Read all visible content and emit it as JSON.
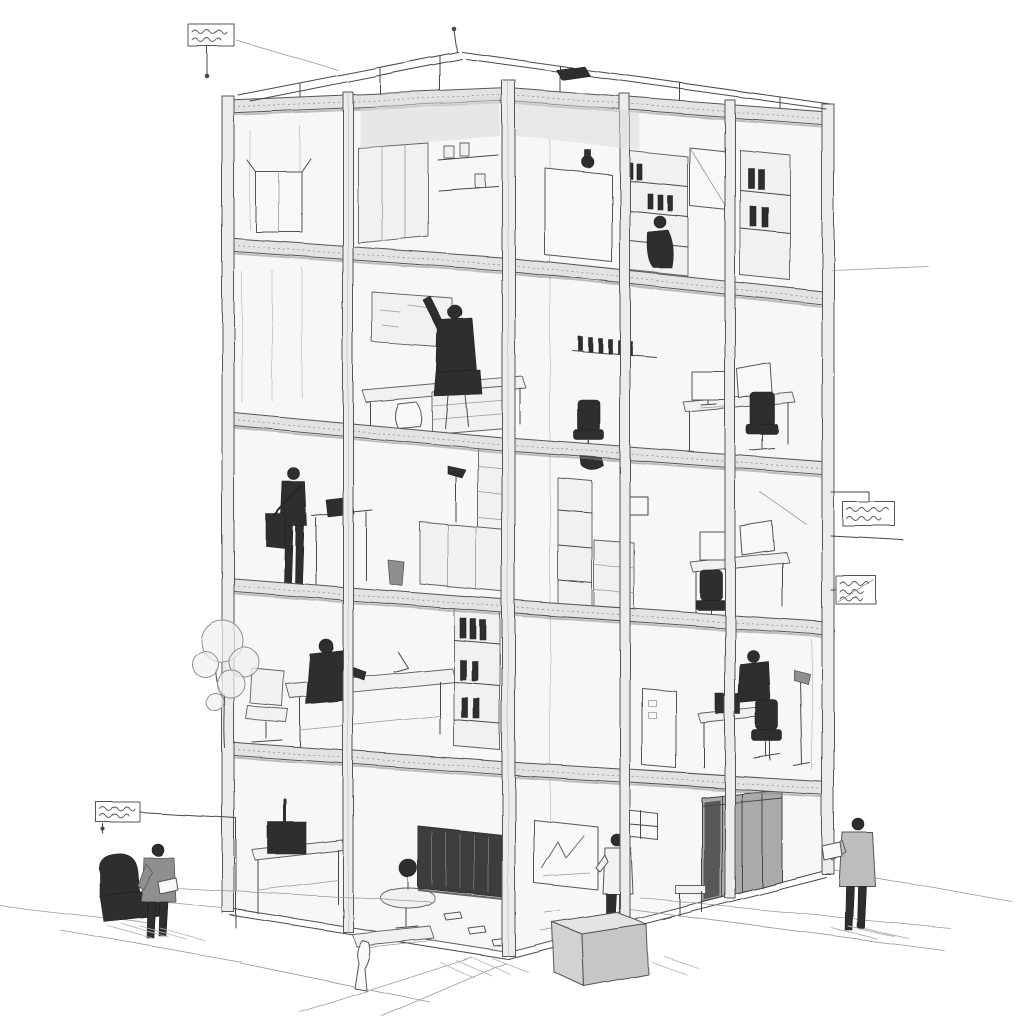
{
  "scene": {
    "kind": "Hand-drawn architectural concept sketch",
    "projection": "two-point perspective dollhouse cutaway",
    "subject": "Five-storey post-and-beam office building cutaway with furnished interiors, rooftop frame, site figures, a young tree and four handwritten callout notes",
    "paper_color": "#ffffff",
    "ink_color": "#474747"
  },
  "building": {
    "storeys_visible": 5,
    "roof": "open beam frame rising to an apex with a small antenna and a dark rooftop unit",
    "frame": "exposed columns and floor slabs; facade removed to reveal rooms on two faces"
  },
  "rooms": [
    {
      "id": "room-5l-storage",
      "level": 5,
      "side": "left",
      "contents": "open carton with lifted flaps, freestanding partition panel, wall shelf with small boxes"
    },
    {
      "id": "room-5r-shelving",
      "level": 5,
      "side": "right",
      "contents": "counter with dark vase, tall open shelving with books, white cabinet, crouching figure, binder shelf"
    },
    {
      "id": "room-4l-workshop",
      "level": 4,
      "side": "left",
      "contents": "back windows, pin-board, workbench with drawer unit, seated worker raising one arm, small white crouching shape"
    },
    {
      "id": "room-4r-office",
      "level": 4,
      "side": "right",
      "contents": "bottle shelf on wall, desk with two monitors and keyboard, two dark task chairs"
    },
    {
      "id": "room-3l-lectern",
      "level": 3,
      "side": "left",
      "contents": "standing worker with shoulder bag at laptop lectern, tall bookcase, service counter, lamp, waste bin"
    },
    {
      "id": "room-3r-workstation",
      "level": 3,
      "side": "right",
      "contents": "small wall picture, pendant lamp, shelf-and-drawer cabinet, desk with two monitors, dark task chair"
    },
    {
      "id": "room-2l-drafting",
      "level": 2,
      "side": "left",
      "contents": "empty task chair, drafting table with lamp, seated draughtsman, binder shelf"
    },
    {
      "id": "room-2r-study",
      "level": 2,
      "side": "right",
      "contents": "tall white cabinet, desk with dark laptop, seated worker, task chair, floor lamp"
    },
    {
      "id": "room-gl-office",
      "level": 1,
      "side": "left",
      "contents": "equipment table with dark machine, round side table with potted plant, loose papers on the floor"
    },
    {
      "id": "corridor-ground",
      "level": 1,
      "side": "center",
      "contents": "dark slatted service corridor opening"
    },
    {
      "id": "room-gr-meeting",
      "level": 1,
      "side": "right",
      "contents": "whiteboard with sketched chart, standing presenter, high window, grey locker bank, low stool, floor clutter"
    }
  ],
  "figures": [
    {
      "id": "figure-worker-raised-arm",
      "where": "level 4 left workshop",
      "pose": "seated at bench, one arm raised"
    },
    {
      "id": "figure-crouching",
      "where": "level 5 right",
      "pose": "crouching beside shelving"
    },
    {
      "id": "figure-standing-bag",
      "where": "level 3 left",
      "pose": "standing at lectern with shoulder bag"
    },
    {
      "id": "figure-draughtsman",
      "where": "level 2 left",
      "pose": "seated at drafting table"
    },
    {
      "id": "figure-seated-study",
      "where": "level 2 right",
      "pose": "seated at desk"
    },
    {
      "id": "figure-presenter",
      "where": "ground floor right",
      "pose": "standing at whiteboard"
    },
    {
      "id": "figure-visitor",
      "where": "site lower left",
      "pose": "standing, reading papers beside a dark armchair"
    },
    {
      "id": "figure-observer",
      "where": "site lower right",
      "pose": "standing at building corner holding a pad"
    },
    {
      "id": "small-white-figure",
      "where": "entry front corner",
      "pose": "small pale figure by the steps"
    }
  ],
  "site": {
    "left": [
      "young sketched tree",
      "dark armchair",
      "hatched shadow"
    ],
    "entry": [
      "front step platform",
      "large three-quarter crate"
    ],
    "ground": "perspective pavement joint lines radiating toward the lower corners"
  },
  "callouts": [
    {
      "id": "callout-top-left",
      "writing": "illegible handwriting, two scribbled lines",
      "leader": "drops vertically to the roof frame"
    },
    {
      "id": "callout-right-upper",
      "writing": "illegible handwriting, two scribbled lines",
      "leader": "steps left to the upper slab edge"
    },
    {
      "id": "callout-right-lower",
      "writing": "illegible handwriting, struck through",
      "leader": "long rule toward the facade at mid-height"
    },
    {
      "id": "callout-bottom-left",
      "writing": "illegible handwriting, two scribbled lines",
      "leader": "runs right then down beside the site figure"
    }
  ],
  "palette": {
    "ink": "#474747",
    "light_wash": "#e3e3e3",
    "mid_wash": "#ababab",
    "dark_fill": "#2e2e2e",
    "paper": "#ffffff"
  }
}
